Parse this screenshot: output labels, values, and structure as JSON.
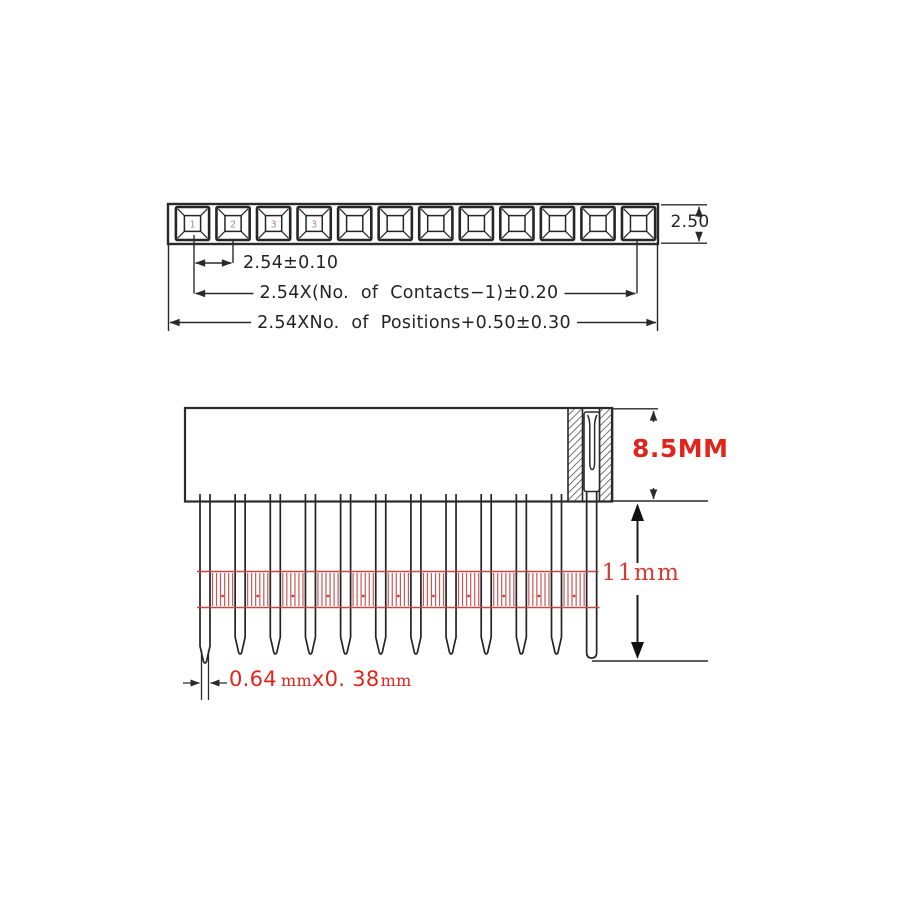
{
  "colors": {
    "line": "#2a2a2a",
    "dim_text": "#242424",
    "red_text": "#e0251c",
    "red_dim": "#d43c36",
    "red_band": "#c24743"
  },
  "top_view": {
    "socket_count": 12,
    "socket_digits": [
      "1",
      "2",
      "3",
      "3"
    ],
    "dim_height": "2.50",
    "dim_pitch": "2.54±0.10",
    "dim_contacts": "2.54X(No. of Contacts−1)±0.20",
    "dim_positions": "2.54XNo. of Positions+0.50±0.30"
  },
  "side_view": {
    "pin_count": 12,
    "dim_body_height": "8.5MM",
    "dim_pin_length": "11mm",
    "dim_pin_tail": {
      "value1": "0.64",
      "unit1": "mm",
      "value2": "x0. 38",
      "unit2": "mm"
    }
  }
}
